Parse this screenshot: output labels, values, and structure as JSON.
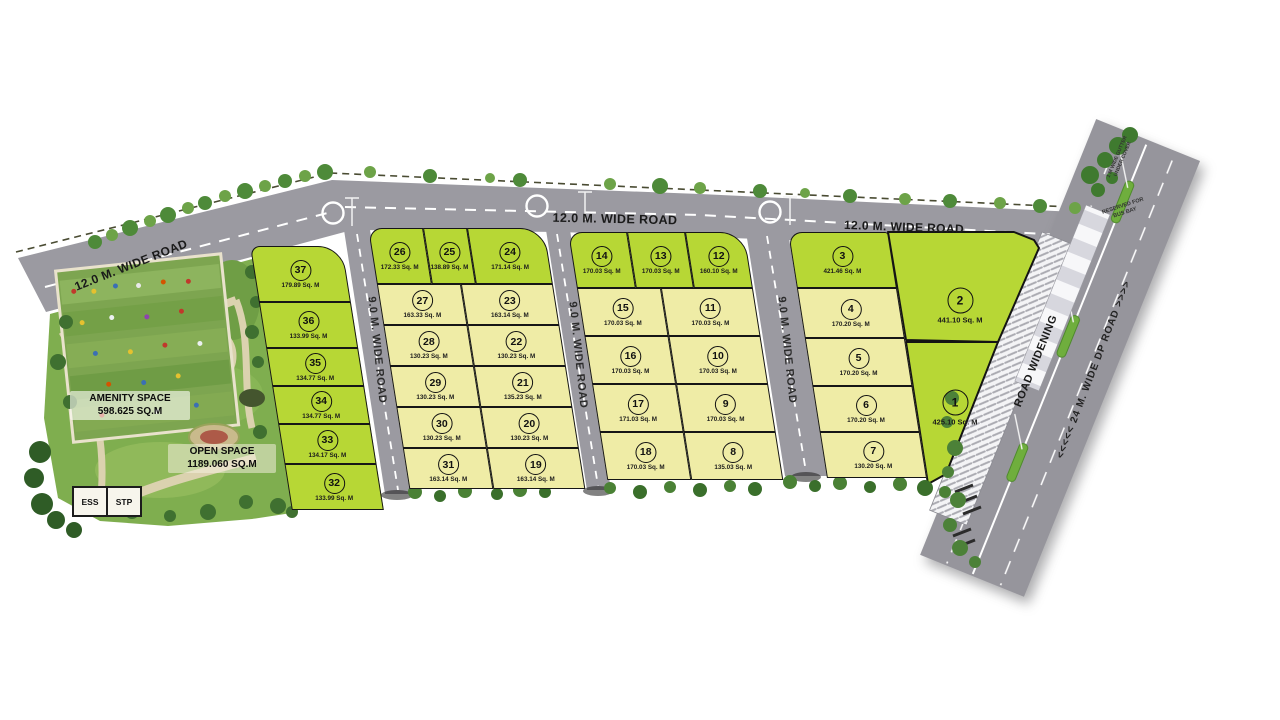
{
  "map": {
    "road_labels": {
      "top_left": "12.0 M. WIDE ROAD",
      "top_center": "12.0 M. WIDE ROAD",
      "top_right": "12.0 M. WIDE ROAD",
      "vertical_1": "9.0 M. WIDE ROAD",
      "vertical_2": "9.0 M. WIDE ROAD",
      "vertical_3": "9.0 M. WIDE ROAD",
      "dp_road": "<<<<<  24 M. WIDE DP ROAD  >>>>",
      "road_widening": "ROAD WIDENING",
      "gutter_note_1": "1 M WIDE GUTTER",
      "gutter_note_2": "UNDER COVER",
      "reserved_note_1": "RESERVED FOR",
      "reserved_note_2": "BUS BAY"
    },
    "park": {
      "amenity_space_title": "AMENITY SPACE",
      "amenity_space_area": "598.625 SQ.M",
      "open_space_title": "OPEN SPACE",
      "open_space_area": "1189.060 SQ.M",
      "ess_label": "ESS",
      "stp_label": "STP"
    },
    "colors": {
      "plot_green": "#b7d735",
      "plot_yellow": "#efeca6",
      "road_gray": "#9b9aa1",
      "park_green": "#7fae4f"
    },
    "plots": {
      "block_a": [
        {
          "no": "37",
          "area": "179.89 Sq. M",
          "shade": "green"
        },
        {
          "no": "36",
          "area": "133.99 Sq. M",
          "shade": "green"
        },
        {
          "no": "35",
          "area": "134.77 Sq. M",
          "shade": "green"
        },
        {
          "no": "34",
          "area": "134.77 Sq. M",
          "shade": "green"
        },
        {
          "no": "33",
          "area": "134.17 Sq. M",
          "shade": "green"
        },
        {
          "no": "32",
          "area": "133.99 Sq. M",
          "shade": "green"
        }
      ],
      "block_b_top": [
        {
          "no": "26",
          "area": "172.33 Sq. M",
          "shade": "green"
        },
        {
          "no": "25",
          "area": "138.89 Sq. M",
          "shade": "green"
        },
        {
          "no": "24",
          "area": "171.14 Sq. M",
          "shade": "green"
        }
      ],
      "block_b_grid": [
        {
          "no": "27",
          "area": "163.33 Sq. M",
          "shade": "yellow"
        },
        {
          "no": "23",
          "area": "163.14 Sq. M",
          "shade": "yellow"
        },
        {
          "no": "28",
          "area": "130.23 Sq. M",
          "shade": "yellow"
        },
        {
          "no": "22",
          "area": "130.23 Sq. M",
          "shade": "yellow"
        },
        {
          "no": "29",
          "area": "130.23 Sq. M",
          "shade": "yellow"
        },
        {
          "no": "21",
          "area": "135.23 Sq. M",
          "shade": "yellow"
        },
        {
          "no": "30",
          "area": "130.23 Sq. M",
          "shade": "yellow"
        },
        {
          "no": "20",
          "area": "130.23 Sq. M",
          "shade": "yellow"
        },
        {
          "no": "31",
          "area": "163.14 Sq. M",
          "shade": "yellow"
        },
        {
          "no": "19",
          "area": "163.14 Sq. M",
          "shade": "yellow"
        }
      ],
      "block_c_top": [
        {
          "no": "14",
          "area": "170.03 Sq. M",
          "shade": "green"
        },
        {
          "no": "13",
          "area": "170.03 Sq. M",
          "shade": "green"
        },
        {
          "no": "12",
          "area": "160.10 Sq. M",
          "shade": "green"
        }
      ],
      "block_c_grid": [
        {
          "no": "15",
          "area": "170.03 Sq. M",
          "shade": "yellow"
        },
        {
          "no": "11",
          "area": "170.03 Sq. M",
          "shade": "yellow"
        },
        {
          "no": "16",
          "area": "170.03 Sq. M",
          "shade": "yellow"
        },
        {
          "no": "10",
          "area": "170.03 Sq. M",
          "shade": "yellow"
        },
        {
          "no": "17",
          "area": "171.03 Sq. M",
          "shade": "yellow"
        },
        {
          "no": "9",
          "area": "170.03 Sq. M",
          "shade": "yellow"
        },
        {
          "no": "18",
          "area": "170.03 Sq. M",
          "shade": "yellow"
        },
        {
          "no": "8",
          "area": "135.03 Sq. M",
          "shade": "yellow"
        }
      ],
      "block_d_col": [
        {
          "no": "3",
          "area": "421.46 Sq. M",
          "shade": "green"
        },
        {
          "no": "4",
          "area": "170.20 Sq. M",
          "shade": "yellow"
        },
        {
          "no": "5",
          "area": "170.20 Sq. M",
          "shade": "yellow"
        },
        {
          "no": "6",
          "area": "170.20 Sq. M",
          "shade": "yellow"
        },
        {
          "no": "7",
          "area": "130.20 Sq. M",
          "shade": "yellow"
        }
      ],
      "block_d_large": [
        {
          "no": "2",
          "area": "441.10 Sq. M",
          "shade": "green"
        },
        {
          "no": "1",
          "area": "425.10 Sq. M",
          "shade": "green"
        }
      ]
    }
  }
}
